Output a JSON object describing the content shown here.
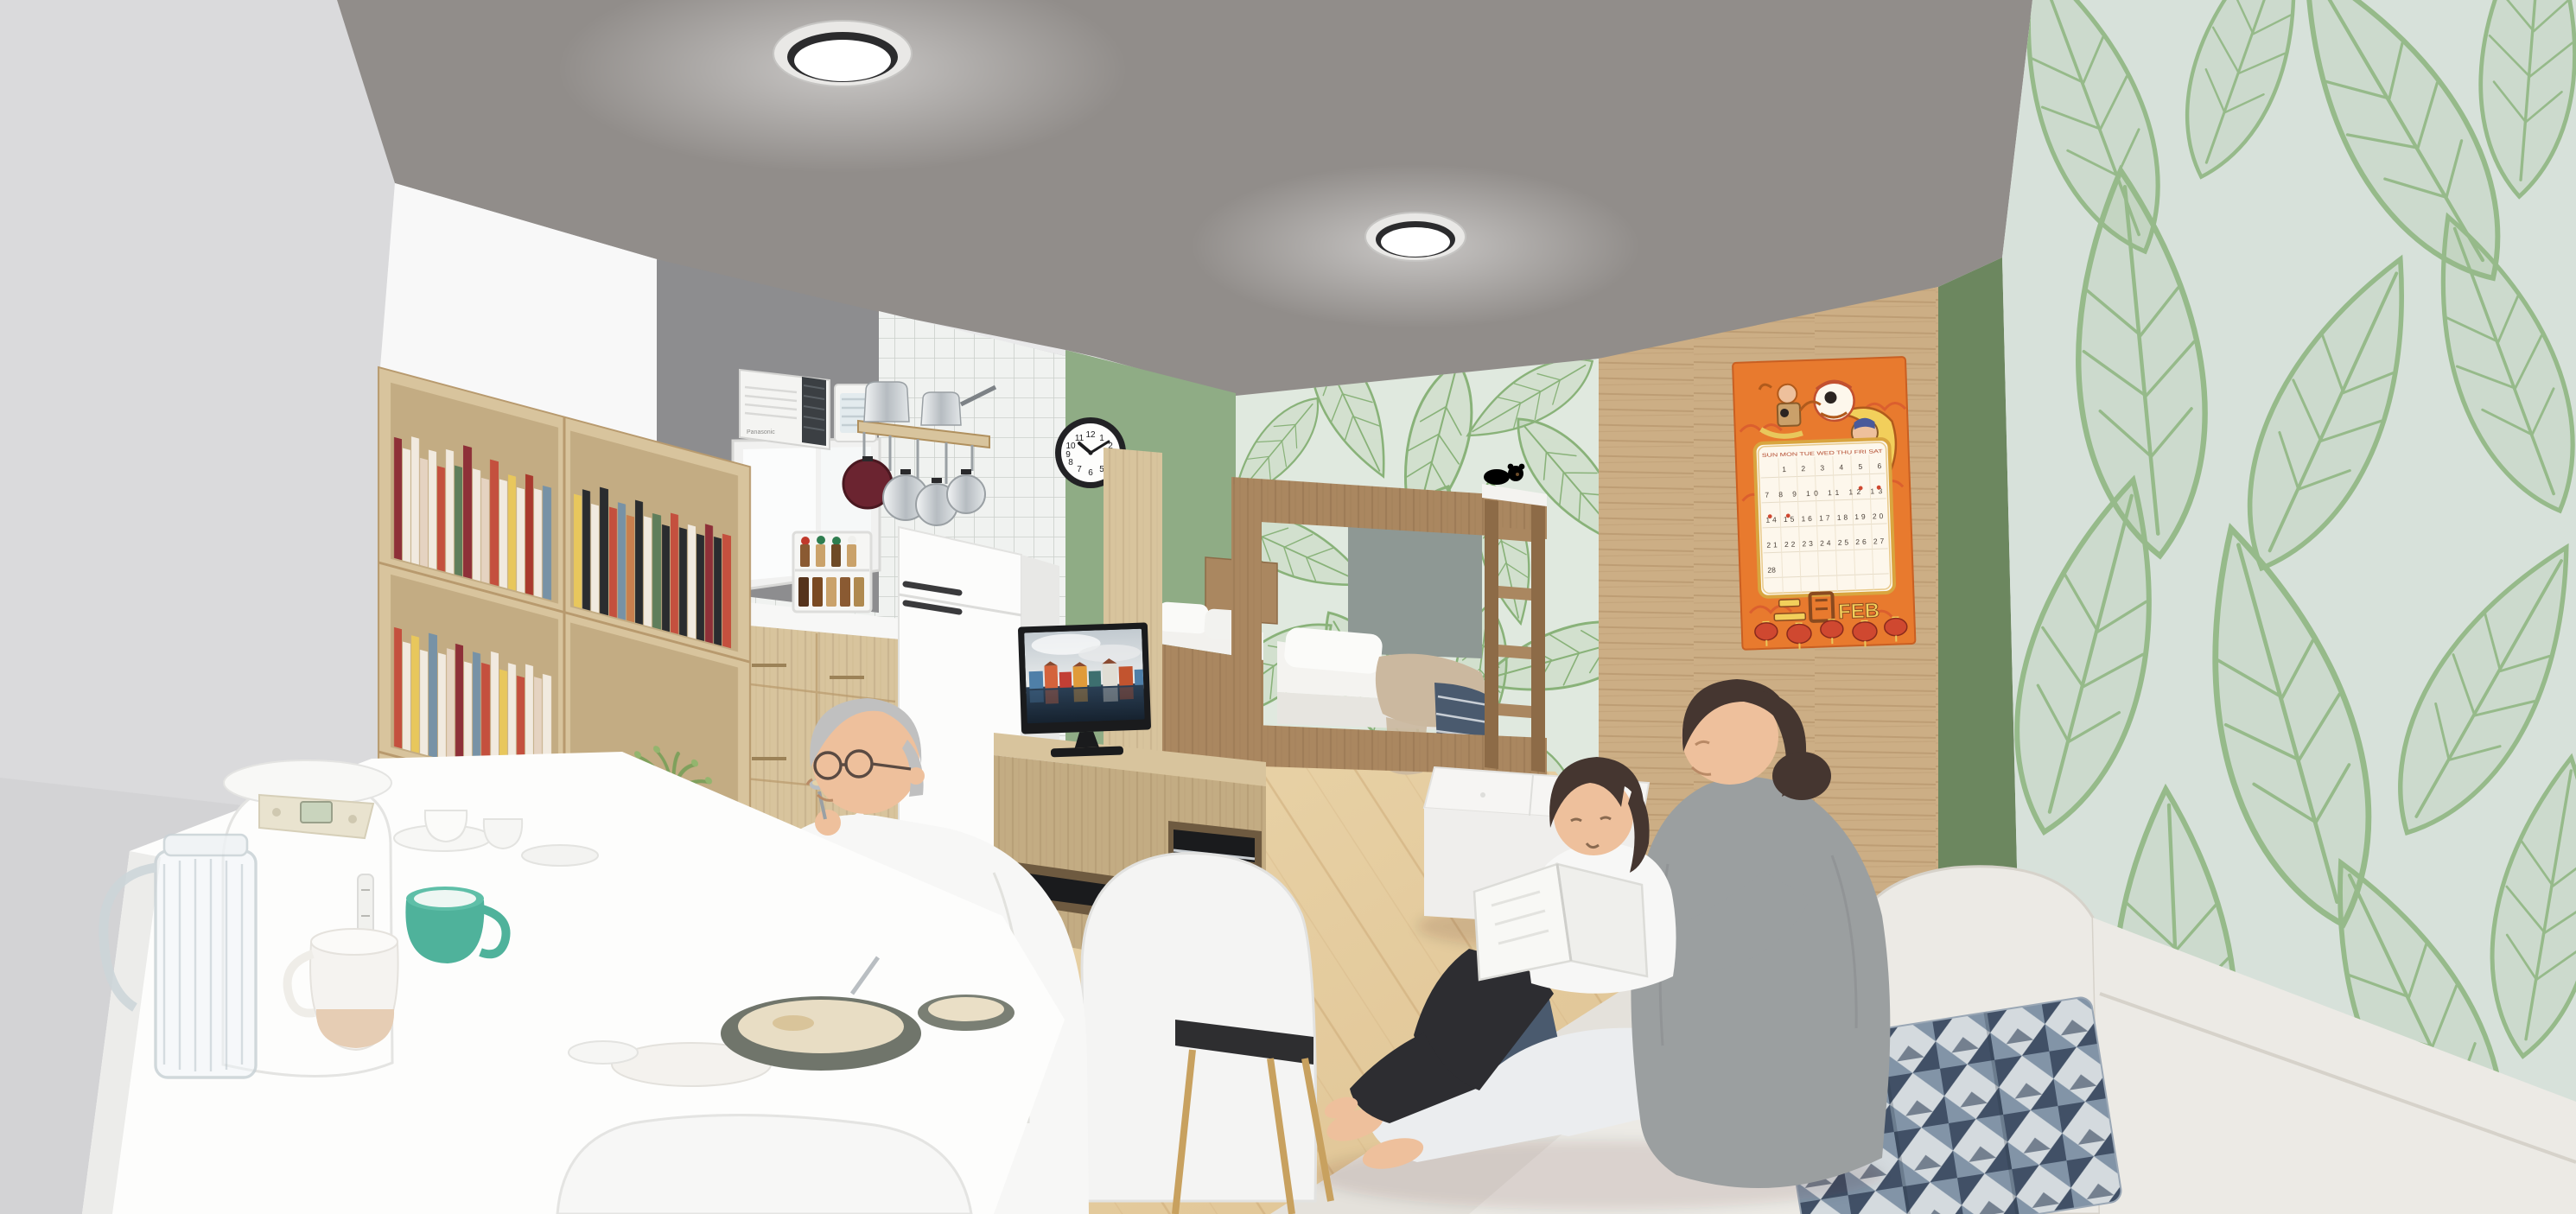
{
  "palette": {
    "ceiling": "#918d8a",
    "wallLeft": "#dadadc",
    "bulkhead": "#f8f8f8",
    "kitchenWall": "#8d8d8f",
    "tile": "#f0f2f0",
    "tileLine": "#cbcfcb",
    "greenWall": "#8fac85",
    "greenDeep": "#7e9b73",
    "greenStrip": "#6c875f",
    "leafBgNear": "#e0e9df",
    "leafBgFar": "#d7e1da",
    "leafStroke": "#7aa968",
    "leafFill": "rgba(122,169,104,0.16)",
    "woodShelf": "#d8c49d",
    "woodShelfDark": "#c3ac83",
    "woodBunk": "#aa8760",
    "woodBunkDark": "#8d6b47",
    "woodPartition": "#ccae85",
    "floorA": "#eedcb3",
    "floorB": "#ddbf8e",
    "floorLine": "#c19a66",
    "white": "#f7f7f6",
    "fridgeWhite": "#fcfcfb",
    "tvBlack": "#1a1b1d",
    "sofa": "#eceae5",
    "sofaShade": "#dcd8d1",
    "cushionNavy": "#415066",
    "cushionSteel": "#8294a7",
    "cushionPale": "#d4dade",
    "skin": "#eec09c",
    "hairGray": "#c0c0c0",
    "hairDark": "#453630",
    "cardigan": "#9b9fa0",
    "legging": "#ebedef",
    "childLegging": "#2d2d31",
    "teal": "#4fb29b",
    "metal": "#c9ced2",
    "posterOrange": "#e87a2e",
    "posterRed": "#cf4830",
    "posterYellow": "#f2cf5b",
    "posterCream": "#fdf7ec",
    "grayPanel": "#8e9894",
    "blanketBeige": "#cbb89f",
    "blanketNavy": "#4a5a6e",
    "bookColors": [
      "#8e3038",
      "#f1eadf",
      "#c4503e",
      "#e8c75c",
      "#2a2c2f",
      "#7792a6",
      "#c97f4e",
      "#e5d3c1",
      "#5f7e5b",
      "#a93a2e"
    ]
  },
  "calendar": {
    "month_zh": "二月",
    "month_en": "FEB",
    "weekdays": "SUN MON TUE WED THU FRI SAT",
    "week1": "1 2 3 4 5 6",
    "week2": "7 8 9 10 11 12 13",
    "week3": "14 15 16 17 18 19 20",
    "week4": "21 22 23 24 25 26 27",
    "week5": "28"
  },
  "clock": {
    "numerals": [
      "12",
      "1",
      "2",
      "3",
      "4",
      "5",
      "6",
      "7",
      "8",
      "9",
      "10",
      "11"
    ],
    "time": "10:10"
  },
  "ac": {
    "brand": "Panasonic"
  }
}
